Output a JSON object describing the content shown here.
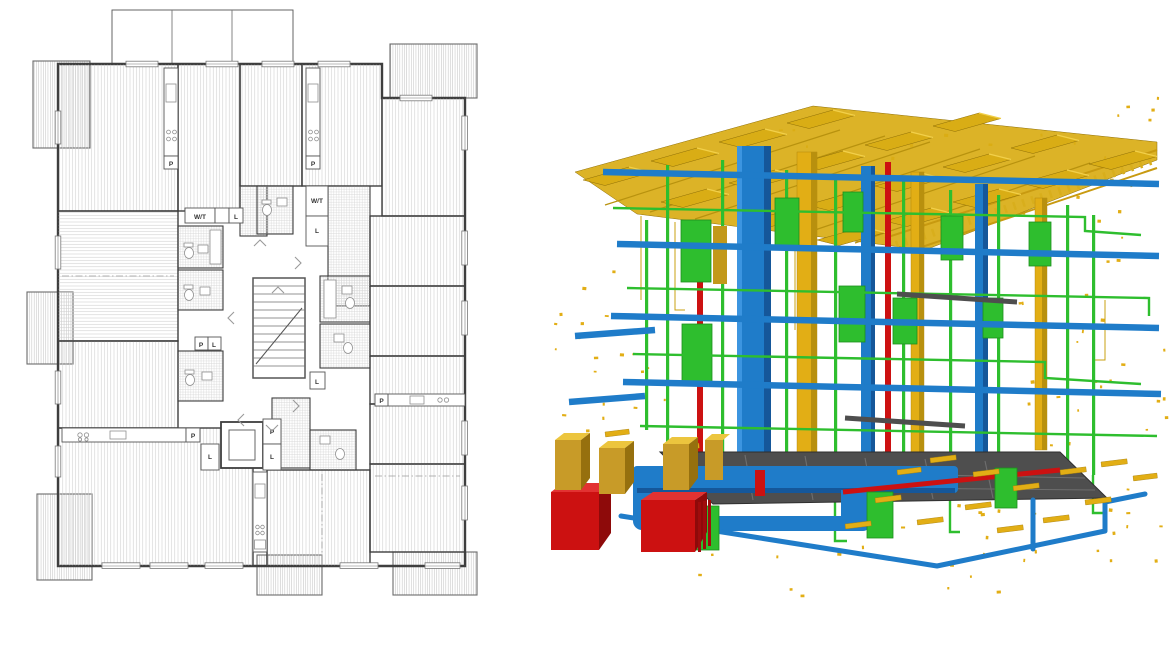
{
  "figure": {
    "left_panel": "2d-architectural-floor-plan",
    "right_panel": "3d-bim-mep-model"
  },
  "floor_plan": {
    "labels": {
      "p": "P",
      "l": "L",
      "wt": "W/T"
    },
    "colors": {
      "wall": "#3e3e3e",
      "hatch": "#cccccc",
      "background": "#ffffff"
    }
  },
  "bim_model": {
    "colors": {
      "ventilation_blue": "#1f7cc9",
      "ventilation_blue_dark": "#15579a",
      "pipe_green": "#2ebe2e",
      "pipe_green_dark": "#1d8f1d",
      "solar_panel_gold": "#d9ad15",
      "electrical_yellow": "#e2ae15",
      "heating_red": "#cc1111",
      "cable_tray_gray": "#4e4e4e"
    }
  },
  "palette": {
    "wall": "#3e3e3e",
    "hatch": "#cccccc",
    "duct_blue": "#1f7cc9",
    "duct_blue_dark": "#15579a",
    "duct_blue_light": "#3c95e0",
    "pipe_green": "#2ebe2e",
    "pipe_green_dark": "#1d8f1d",
    "panel_gold": "#d9ad15",
    "panel_gold_light": "#f2d04a",
    "panel_gold_dark": "#96700e",
    "elec_yellow": "#e2ae15",
    "heat_red": "#cc1111",
    "heat_red_dark": "#8e0a0a",
    "tray_gray": "#4e4e4e"
  }
}
